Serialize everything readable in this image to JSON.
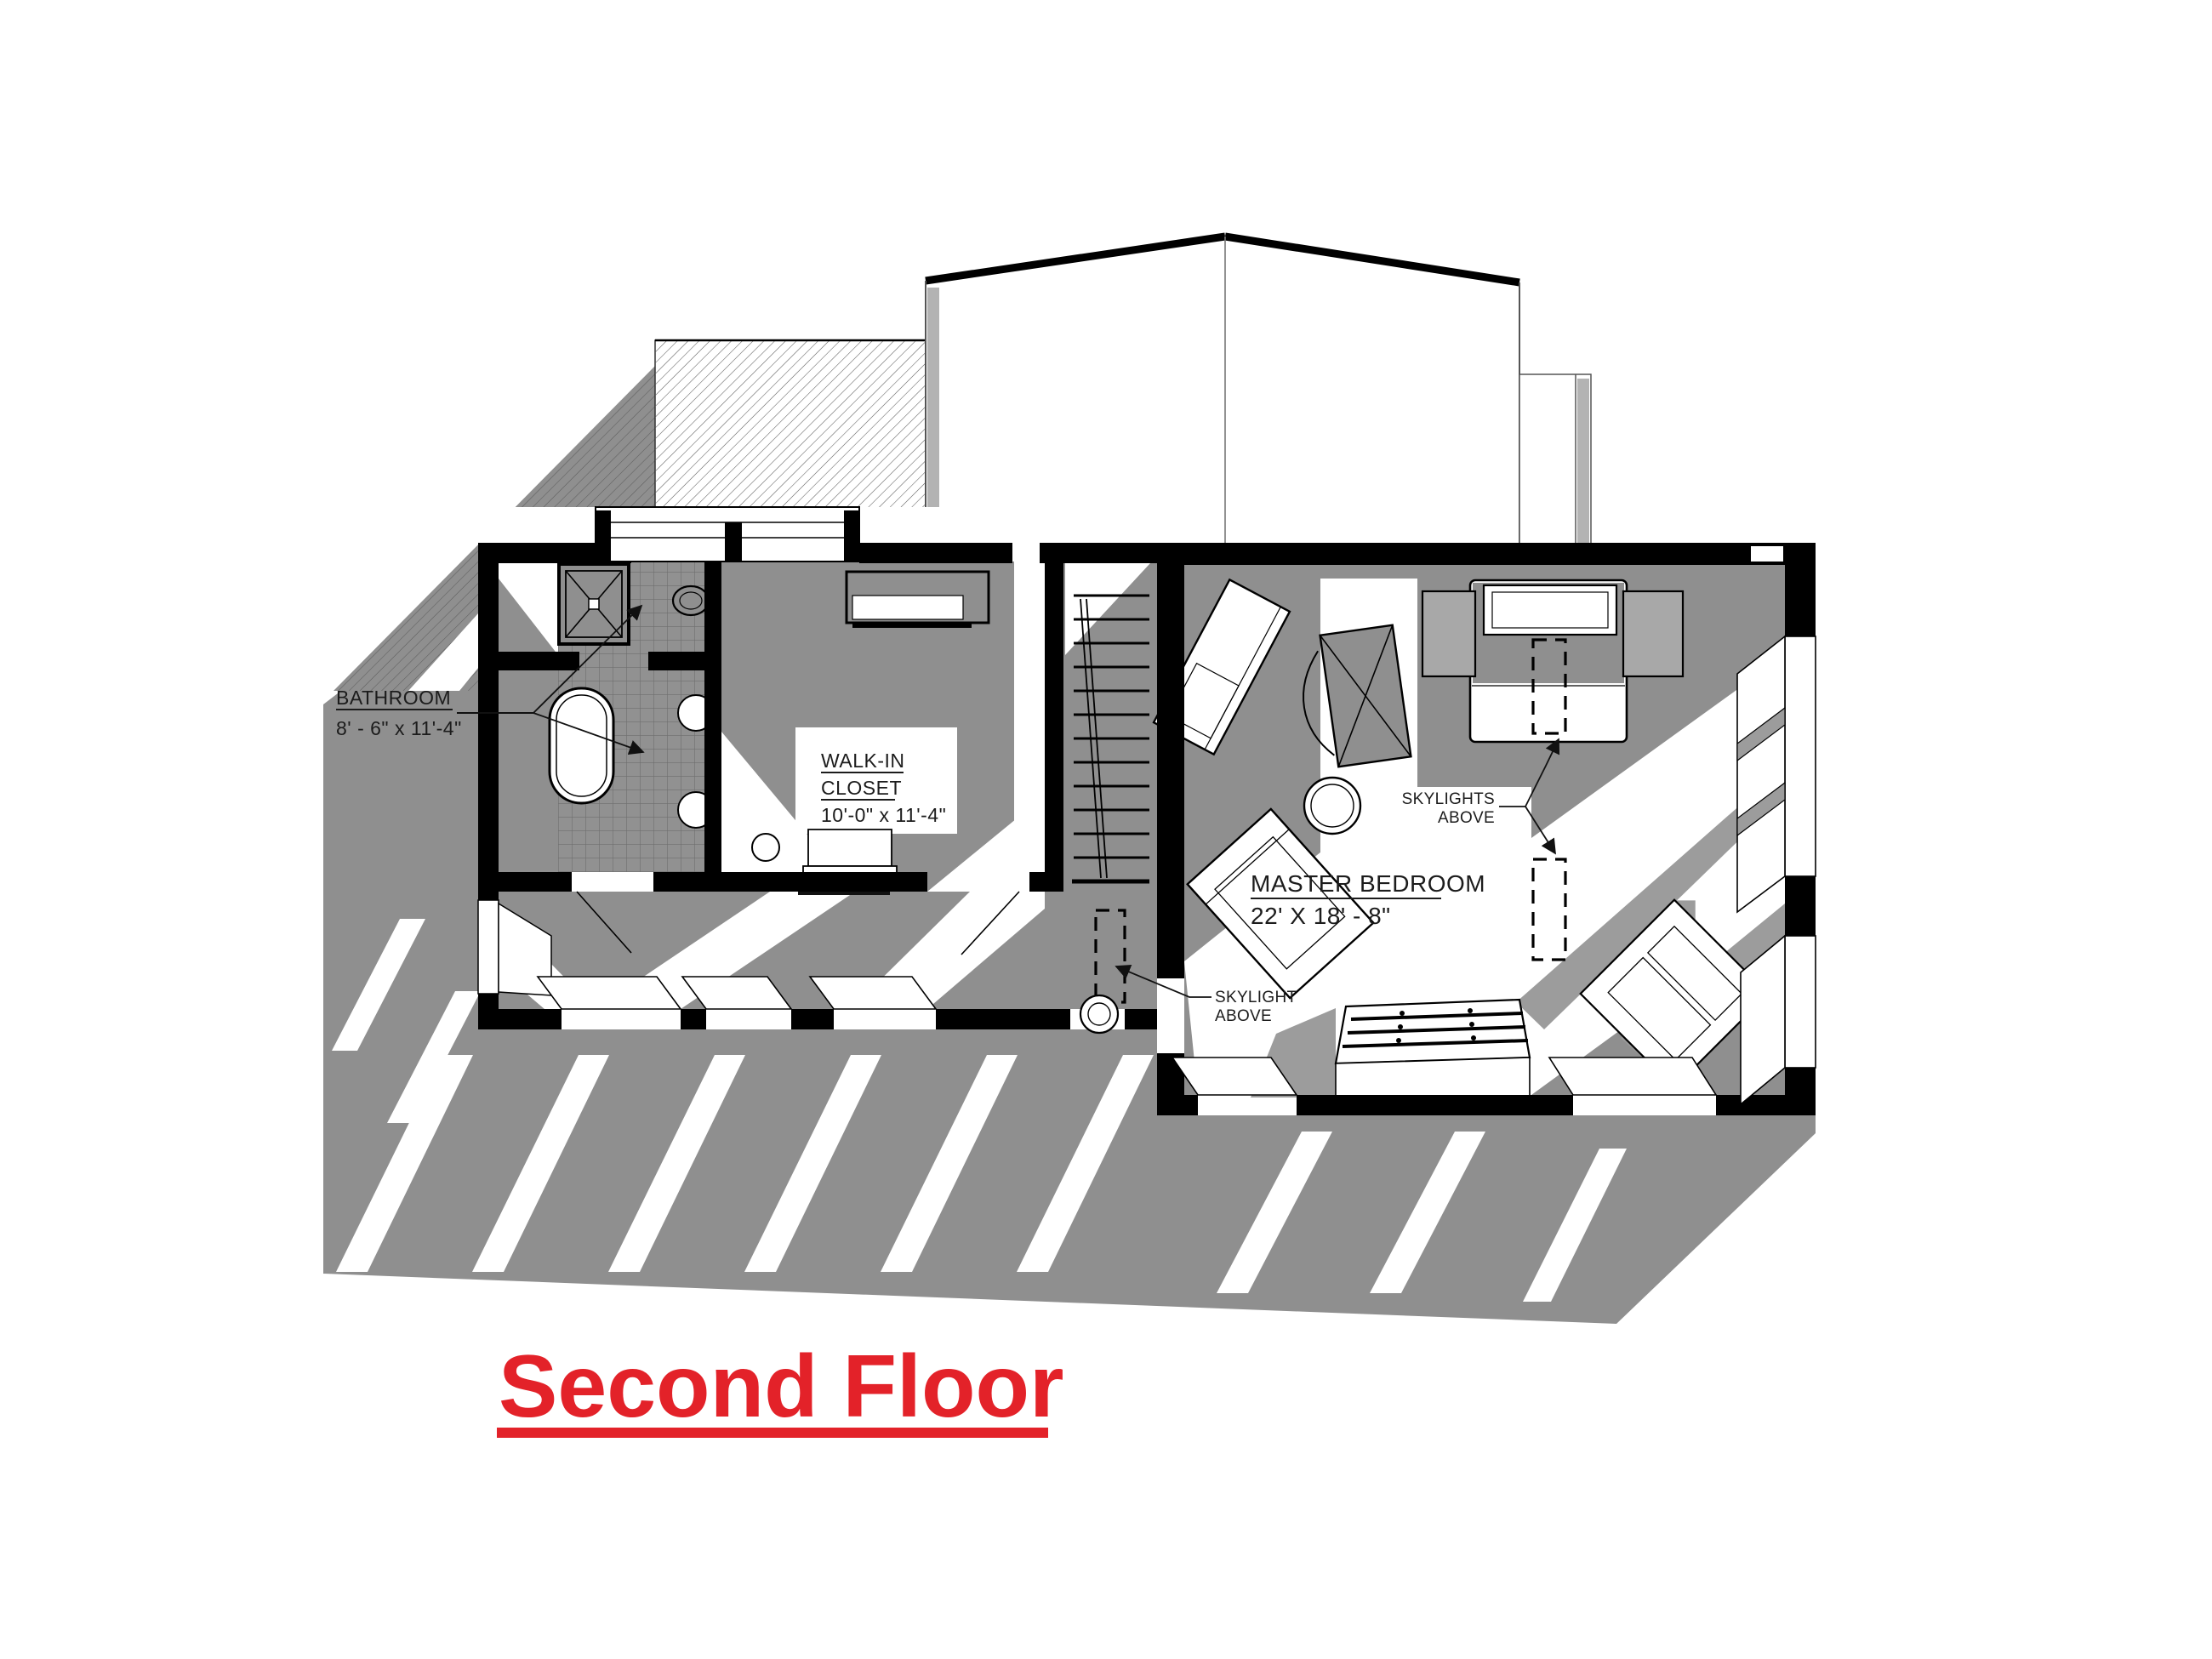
{
  "drawing": {
    "title": {
      "text": "Second Floor"
    },
    "rooms": {
      "bathroom": {
        "name": "BATHROOM",
        "dims": "8' - 6\" x 11'-4\""
      },
      "walk_in_closet": {
        "name_line1": "WALK-IN",
        "name_line2": "CLOSET",
        "dims": "10'-0\" x 11'-4\""
      },
      "master_bedroom": {
        "name": "MASTER BEDROOM",
        "dims": "22' X 18' - 8\""
      }
    },
    "annotations": {
      "skylights_above": {
        "line1": "SKYLIGHTS",
        "line2": "ABOVE"
      },
      "skylight_above": {
        "line1": "SKYLIGHT",
        "line2": "ABOVE"
      }
    },
    "colors": {
      "accent_red": "#e32229",
      "shadow_gray": "#8f8f8f",
      "beam_gray": "#9c9c9c",
      "tile_gray": "#919191",
      "wall_black": "#000000"
    }
  }
}
